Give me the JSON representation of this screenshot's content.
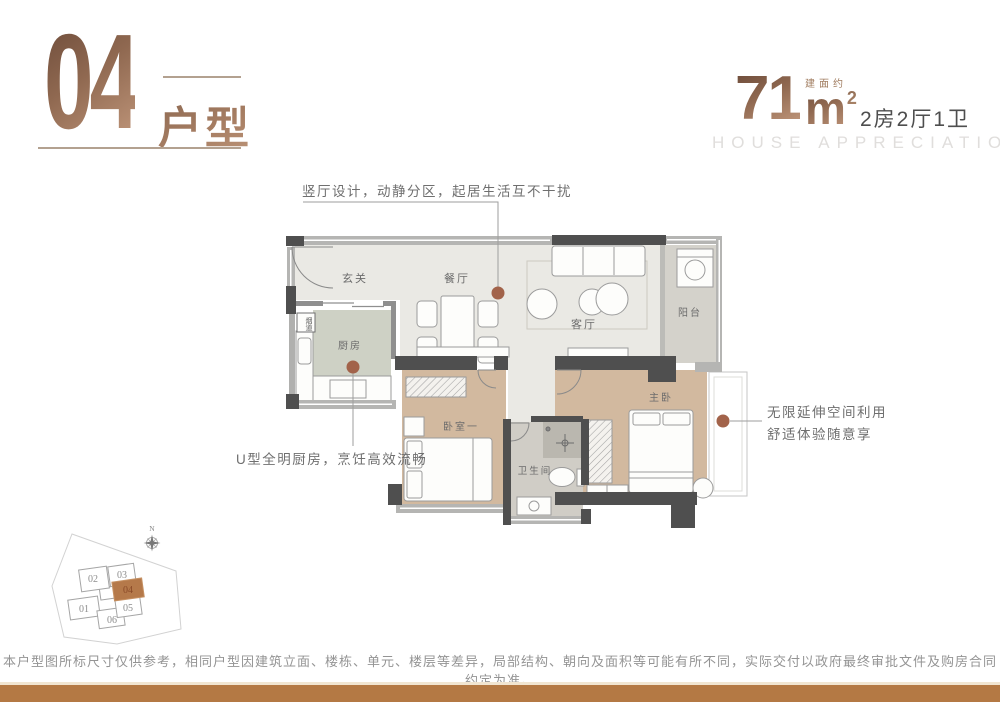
{
  "header": {
    "unit_number": "04",
    "unit_suffix": "户型",
    "area_value": "71",
    "area_prefix": "建面约",
    "area_unit": "m",
    "area_exponent": "2",
    "spec": "2房2厅1卫",
    "tagline": "HOUSE APPRECIATION"
  },
  "annotations": {
    "living_dining": "竖厅设计，动静分区，起居生活互不干扰",
    "kitchen": "U型全明厨房，烹饪高效流畅",
    "master_line1": "无限延伸空间利用",
    "master_line2": "舒适体验随意享"
  },
  "floorplan": {
    "rooms": {
      "entry": "玄关",
      "dining": "餐厅",
      "living": "客厅",
      "balcony": "阳台",
      "kitchen": "厨房",
      "flue": "烟道",
      "bedroom1": "卧室一",
      "bathroom": "卫生间",
      "master": "主卧"
    }
  },
  "siteplan": {
    "compass": "N",
    "highlighted_unit": "04",
    "units": [
      {
        "label": "01"
      },
      {
        "label": "02"
      },
      {
        "label": "03"
      },
      {
        "label": "04"
      },
      {
        "label": "05"
      },
      {
        "label": "06"
      }
    ]
  },
  "footer": {
    "disclaimer": "本户型图所标尺寸仅供参考，相同户型因建筑立面、楼栋、单元、楼层等差异，局部结构、朝向及面积等可能有所不同，实际交付以政府最终审批文件及购房合同约定为准。"
  },
  "colors": {
    "accent_bronze": "#a9805f",
    "band_orange": "#b47944",
    "annotation_dot": "#a2634a",
    "siteplan_highlight": "#b5794a",
    "wall_dark": "#4f4f4f",
    "floor_wood": "#d2b99f"
  }
}
